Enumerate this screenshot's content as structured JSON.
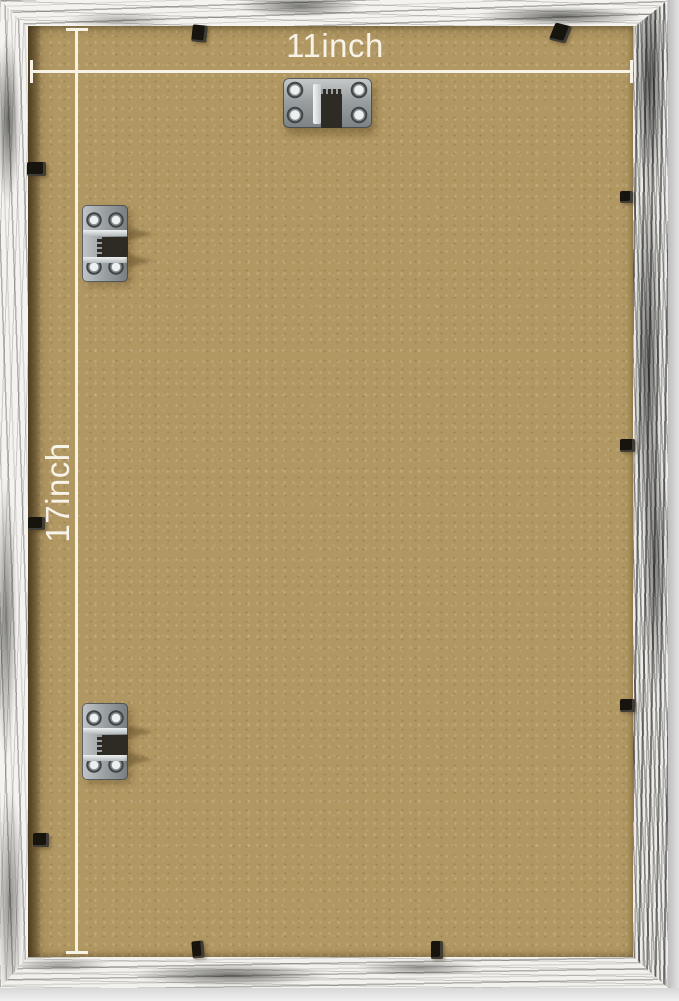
{
  "annotations": {
    "width_label": "11inch",
    "height_label": "17inch",
    "line_color": "#f6f2e6"
  },
  "colors": {
    "backing_board": "#b19762",
    "frame_base": "#f4f3ef",
    "frame_distress": "#1c1b19",
    "frame_side_edge": "#d9d9d9",
    "retainer_clip": "#17140e",
    "hardware_metal": "#9aa0a2"
  },
  "hardware": {
    "sawtooth_hanger_count": 1,
    "side_hinge_count": 2,
    "retainer_clip_count": 10
  }
}
